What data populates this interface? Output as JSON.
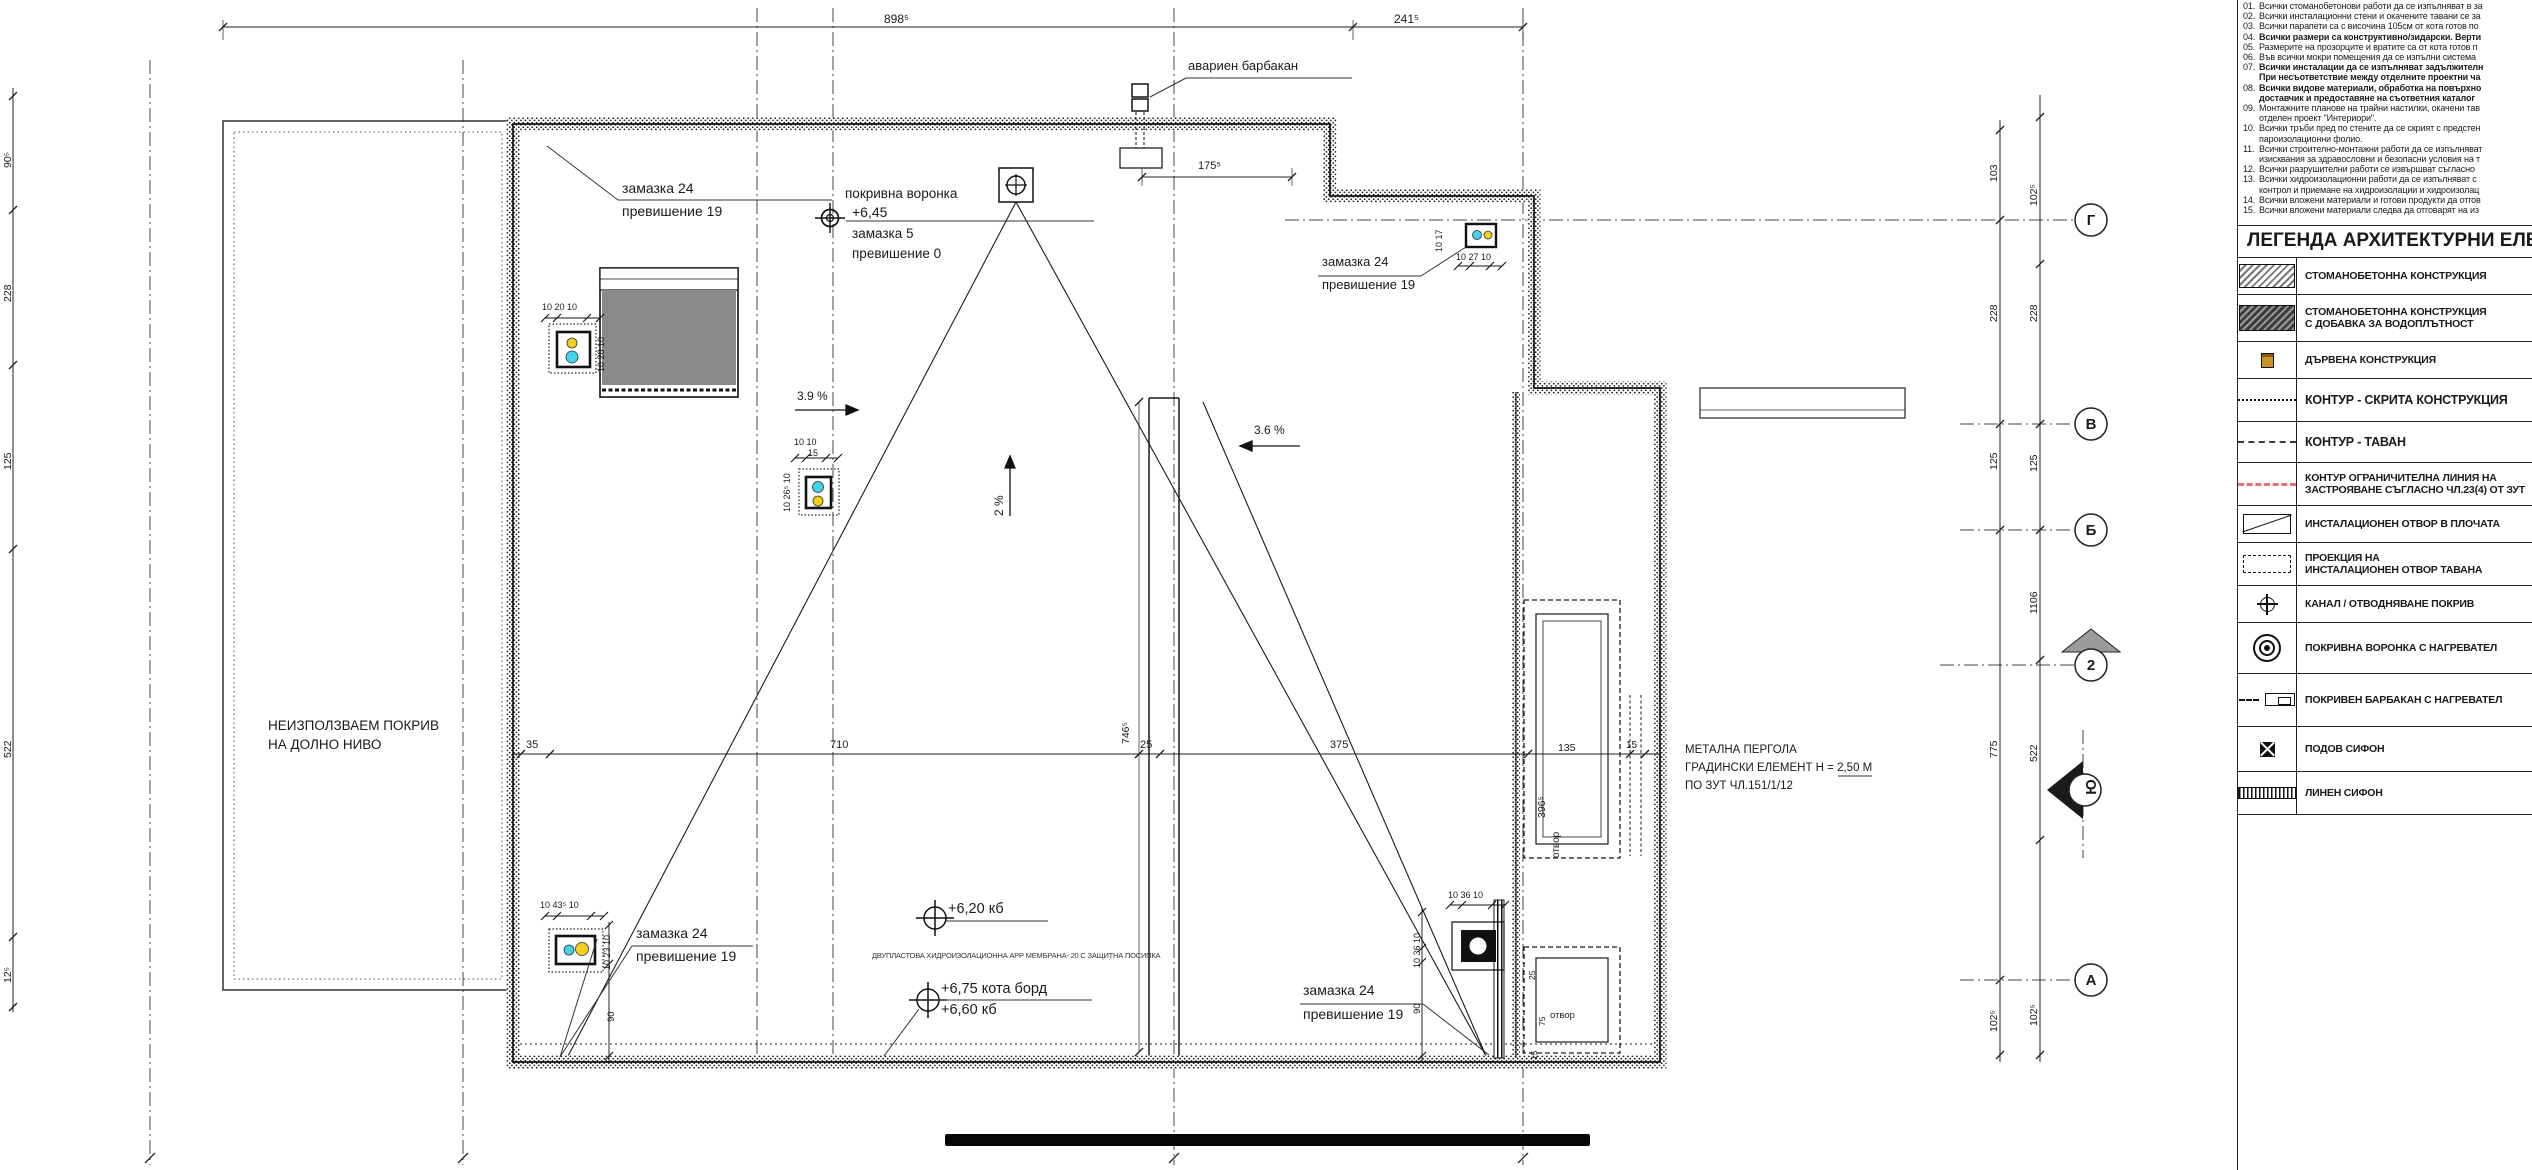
{
  "plan": {
    "top_dims": [
      "898⁵",
      "241⁵"
    ],
    "left_dims": [
      "90⁵",
      "228",
      "125",
      "522",
      "12⁵"
    ],
    "right_dims_inner": [
      "103",
      "228",
      "125",
      "775",
      "102⁵"
    ],
    "right_dims_outer": [
      "102⁵",
      "228",
      "125",
      "1106",
      "522",
      "102⁵"
    ],
    "mid_dims": [
      "35",
      "710",
      "25",
      "375",
      "135",
      "15"
    ],
    "dim_746": "746⁵",
    "dim_396": "396⁵",
    "dim_175": "175⁵",
    "shaft_dims": [
      "25",
      "75",
      "15"
    ],
    "otvor": "отвор",
    "grid_letters": [
      "Г",
      "В",
      "Б",
      "2",
      "Ю",
      "А"
    ],
    "labels": {
      "barbakan": "авариен барбакан",
      "zamazka24": "замазка 24",
      "prev19": "превишение 19",
      "vorona_title": "покривна воронка",
      "vorona_level": "+6,45",
      "zamazka5": "замазка 5",
      "prev0": "превишение 0",
      "unused1": "НЕИЗПОЛЗВАЕМ ПОКРИВ",
      "unused2": "НА ДОЛНО НИВО",
      "pergola1": "МЕТАЛНА ПЕРГОЛА",
      "pergola2": "ГРАДИНСКИ ЕЛЕМЕНТ  Н = 2,50 М",
      "pergola3": "ПО ЗУТ ЧЛ.151/1/12",
      "kb620": "+6,20 кб",
      "membrane": "ДВУПЛАСТОВА ХИДРОИЗОЛАЦИОННА АРР МЕМБРАНА- 20 С ЗАЩИТНА ПОСИПКА",
      "kota675": "+6,75 кота борд",
      "kb660": "+6,60  кб",
      "slope39": "3.9 %",
      "slope36": "3.6 %",
      "slope2": "2 %"
    },
    "drains": {
      "a_h": "10 20 10",
      "a_v": "10 28 10",
      "b_h": "10  10",
      "b_w": "15",
      "b_v": "10 26⁵ 10",
      "c_h": "10 27 10",
      "c_v": "10 17",
      "d_h": "10 43⁵ 10",
      "d_v": "10 23 10",
      "d_90": "90",
      "e_h": "10 36 10",
      "e_v": "10 36 10",
      "e_90": "90"
    },
    "colors": {
      "cyan": "#43d3e8",
      "yellow": "#f2cf1d",
      "roof_gray": "#8a8a8a",
      "limit_red": "#e57373"
    }
  },
  "notes": {
    "items": [
      {
        "num": "01.",
        "text": "Всички стоманобетонови работи да се изпълняват в за",
        "bold": false
      },
      {
        "num": "02.",
        "text": "Всички инсталационни стени и окачените тавани се за",
        "bold": false
      },
      {
        "num": "03.",
        "text": "Всички парапети са с височина 105см от кота готов по",
        "bold": false
      },
      {
        "num": "04.",
        "text": "Всички размери са конструктивно/зидарски. Верти",
        "bold": true
      },
      {
        "num": "05.",
        "text": "Размерите на прозорците и вратите са от кота готов п",
        "bold": false
      },
      {
        "num": "06.",
        "text": "Във всички мокри помещения да се изпълни система",
        "bold": false
      },
      {
        "num": "07.",
        "text": "Всички инсталации да се изпълняват задължителн",
        "bold": true
      },
      {
        "num": "",
        "text": "При несъответствие между отделните проектни ча",
        "bold": true
      },
      {
        "num": "08.",
        "text": "Всички видове материали, обработка на повърхно",
        "bold": true
      },
      {
        "num": "",
        "text": "доставчик и предоставяне на съответния каталог",
        "bold": true
      },
      {
        "num": "09.",
        "text": "Монтажните планове на трайни настилки, окачени тав",
        "bold": false
      },
      {
        "num": "",
        "text": "отделен проект \"Интериори\".",
        "bold": false
      },
      {
        "num": "10.",
        "text": "Всички тръби пред по стените да се скрият с предстен",
        "bold": false
      },
      {
        "num": "",
        "text": "пароизолационни фолио.",
        "bold": false
      },
      {
        "num": "11.",
        "text": "Всички строително-монтажни работи да се изпълняват",
        "bold": false
      },
      {
        "num": "",
        "text": "изисквания за здравословни и безопасни условия на т",
        "bold": false
      },
      {
        "num": "12.",
        "text": "Всички разрушителни работи се извършват съгласно",
        "bold": false
      },
      {
        "num": "13.",
        "text": "Всички хидроизолационни работи да се изпълняват с",
        "bold": false
      },
      {
        "num": "",
        "text": "контрол и приемане на хидроизолации и хидроизолац",
        "bold": false
      },
      {
        "num": "14.",
        "text": "Всички вложени материали и готови продукти да отгов",
        "bold": false
      },
      {
        "num": "15.",
        "text": "Всички вложени материали следва да отговарят на из",
        "bold": false
      }
    ]
  },
  "legend": {
    "title": "ЛЕГЕНДА АРХИТЕКТУРНИ ЕЛЕМЕНТИ",
    "items": [
      {
        "symbol": "concrete",
        "label": "СТОМАНОБЕТОННА КОНСТРУКЦИЯ"
      },
      {
        "symbol": "concrete-wp",
        "label": "СТОМАНОБЕТОННА КОНСТРУКЦИЯ",
        "label2": "С ДОБАВКА ЗА ВОДОПЛЪТНОСТ"
      },
      {
        "symbol": "wood",
        "label": "ДЪРВЕНА КОНСТРУКЦИЯ"
      },
      {
        "symbol": "hidden",
        "label": "КОНТУР - СКРИТА КОНСТРУКЦИЯ"
      },
      {
        "symbol": "ceiling",
        "label": "КОНТУР - ТАВАН"
      },
      {
        "symbol": "limit",
        "label": "КОНТУР ОГРАНИЧИТЕЛНА ЛИНИЯ НА",
        "label2": "ЗАСТРОЯВАНЕ СЪГЛАСНО ЧЛ.23(4) ОТ ЗУТ"
      },
      {
        "symbol": "slab-open",
        "label": "ИНСТАЛАЦИОНЕН ОТВОР В ПЛОЧАТА"
      },
      {
        "symbol": "ceil-open",
        "label": "ПРОЕКЦИЯ НА",
        "label2": "ИНСТАЛАЦИОНЕН ОТВОР ТАВАНА"
      },
      {
        "symbol": "kanal",
        "label": "КАНАЛ / ОТВОДНЯВАНЕ ПОКРИВ"
      },
      {
        "symbol": "voronka-h",
        "label": "ПОКРИВНА ВОРОНКА С НАГРЕВАТЕЛ"
      },
      {
        "symbol": "barbakan-h",
        "label": "ПОКРИВЕН БАРБАКАН С НАГРЕВАТЕЛ"
      },
      {
        "symbol": "sifon",
        "label": "ПОДОВ СИФОН"
      },
      {
        "symbol": "lin-sifon",
        "label": "ЛИНЕН СИФОН"
      }
    ]
  }
}
